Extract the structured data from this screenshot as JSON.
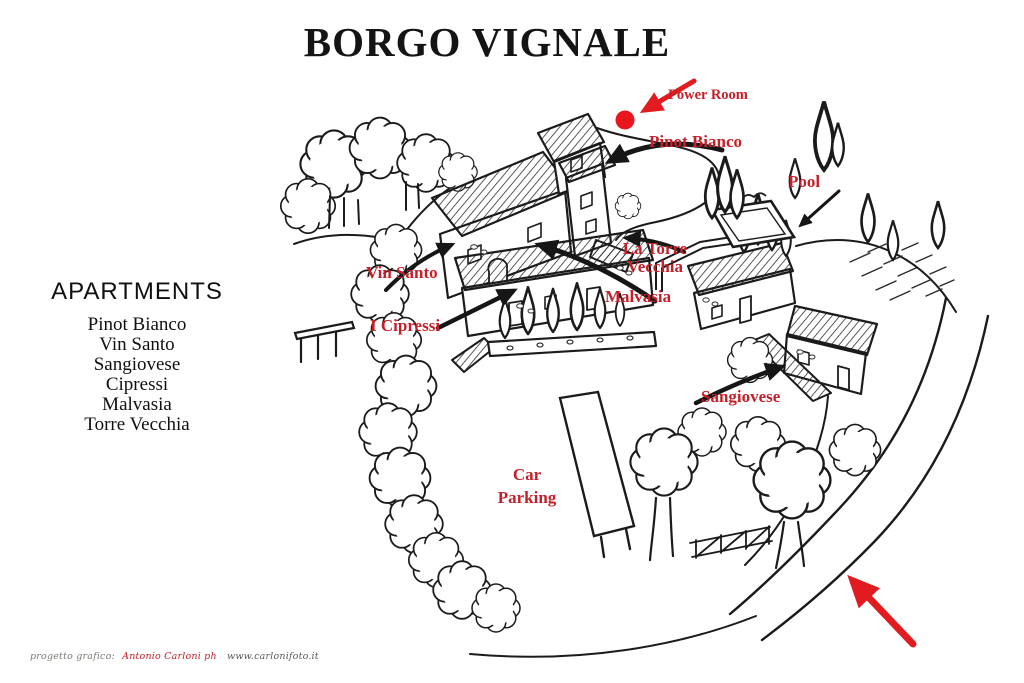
{
  "title": "BORGO VIGNALE",
  "sidebar": {
    "heading": "APARTMENTS",
    "items": [
      "Pinot Bianco",
      "Vin Santo",
      "Sangiovese",
      "Cipressi",
      "Malvasia",
      "Torre Vecchia"
    ]
  },
  "map": {
    "labels": {
      "power_room": "Power Room",
      "pinot_bianco": "Pinot Bianco",
      "pool": "Pool",
      "vin_santo": "Vin Santo",
      "torre_vecchia_line1": "La Torre",
      "torre_vecchia_line2": "Vecchia",
      "malvasia": "Malvasia",
      "i_cipressi": "I Cipressi",
      "sangiovese": "Sangiovese",
      "car_parking_line1": "Car",
      "car_parking_line2": "Parking"
    },
    "icons": {
      "power_room_marker": "red-dot-marker",
      "power_room_arrow": "red-arrow-pointing-to-dot",
      "entrance_arrow": "red-arrow-road-entrance",
      "building_arrows": "black-curved-pointer-arrows"
    },
    "colors": {
      "label_red": "#c5202a",
      "marker_red": "#ea161d",
      "ink": "#1b1b1b"
    }
  },
  "footer": {
    "credit_prefix": "progetto grafico:",
    "credit_name": "Antonio Carloni ph",
    "credit_site": "www.carlonifoto.it"
  }
}
